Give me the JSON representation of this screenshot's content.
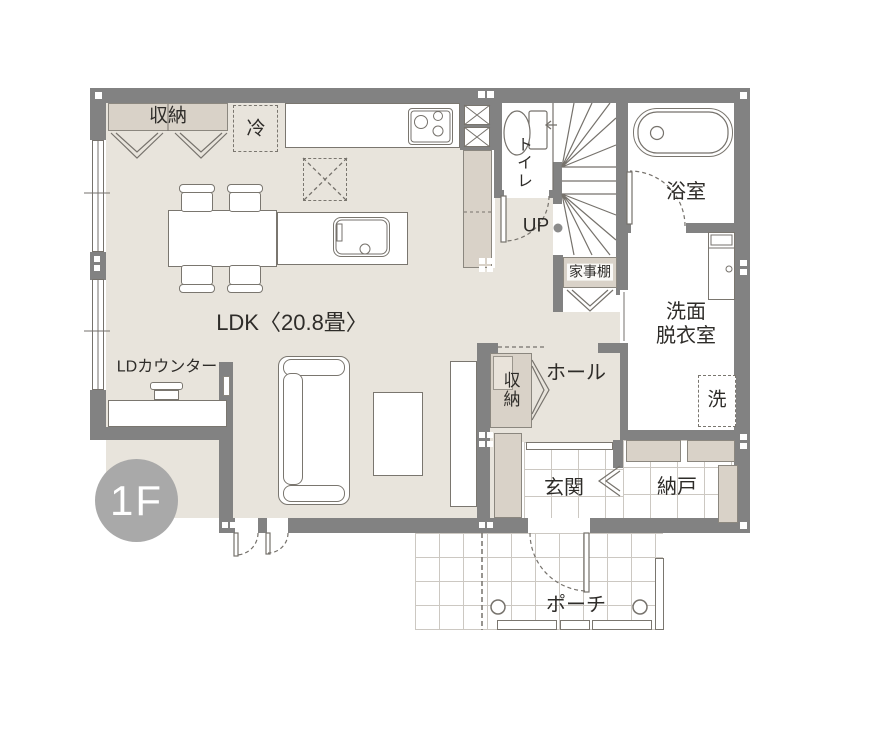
{
  "floor_badge": "1F",
  "labels": {
    "ldk": "LDK〈20.8畳〉",
    "ld_counter": "LDカウンター",
    "kitchen_closet": "収納",
    "fridge": "冷",
    "toilet": "トイレ",
    "up": "UP",
    "housework_shelf": "家事棚",
    "bathroom": "浴室",
    "washroom_lines": [
      "洗面",
      "脱衣室"
    ],
    "washer": "洗",
    "hall": "ホール",
    "hall_closet": "収納",
    "entrance": "玄関",
    "storeroom": "納戸",
    "porch": "ポーチ"
  },
  "colors": {
    "wall": "#828282",
    "floor_beige": "#e8e4dc",
    "storage_fill": "#d9d2c8",
    "line": "#76726c",
    "tile_line": "#ccc8c2",
    "badge": "#a9a9a9",
    "text": "#2e2c29"
  }
}
